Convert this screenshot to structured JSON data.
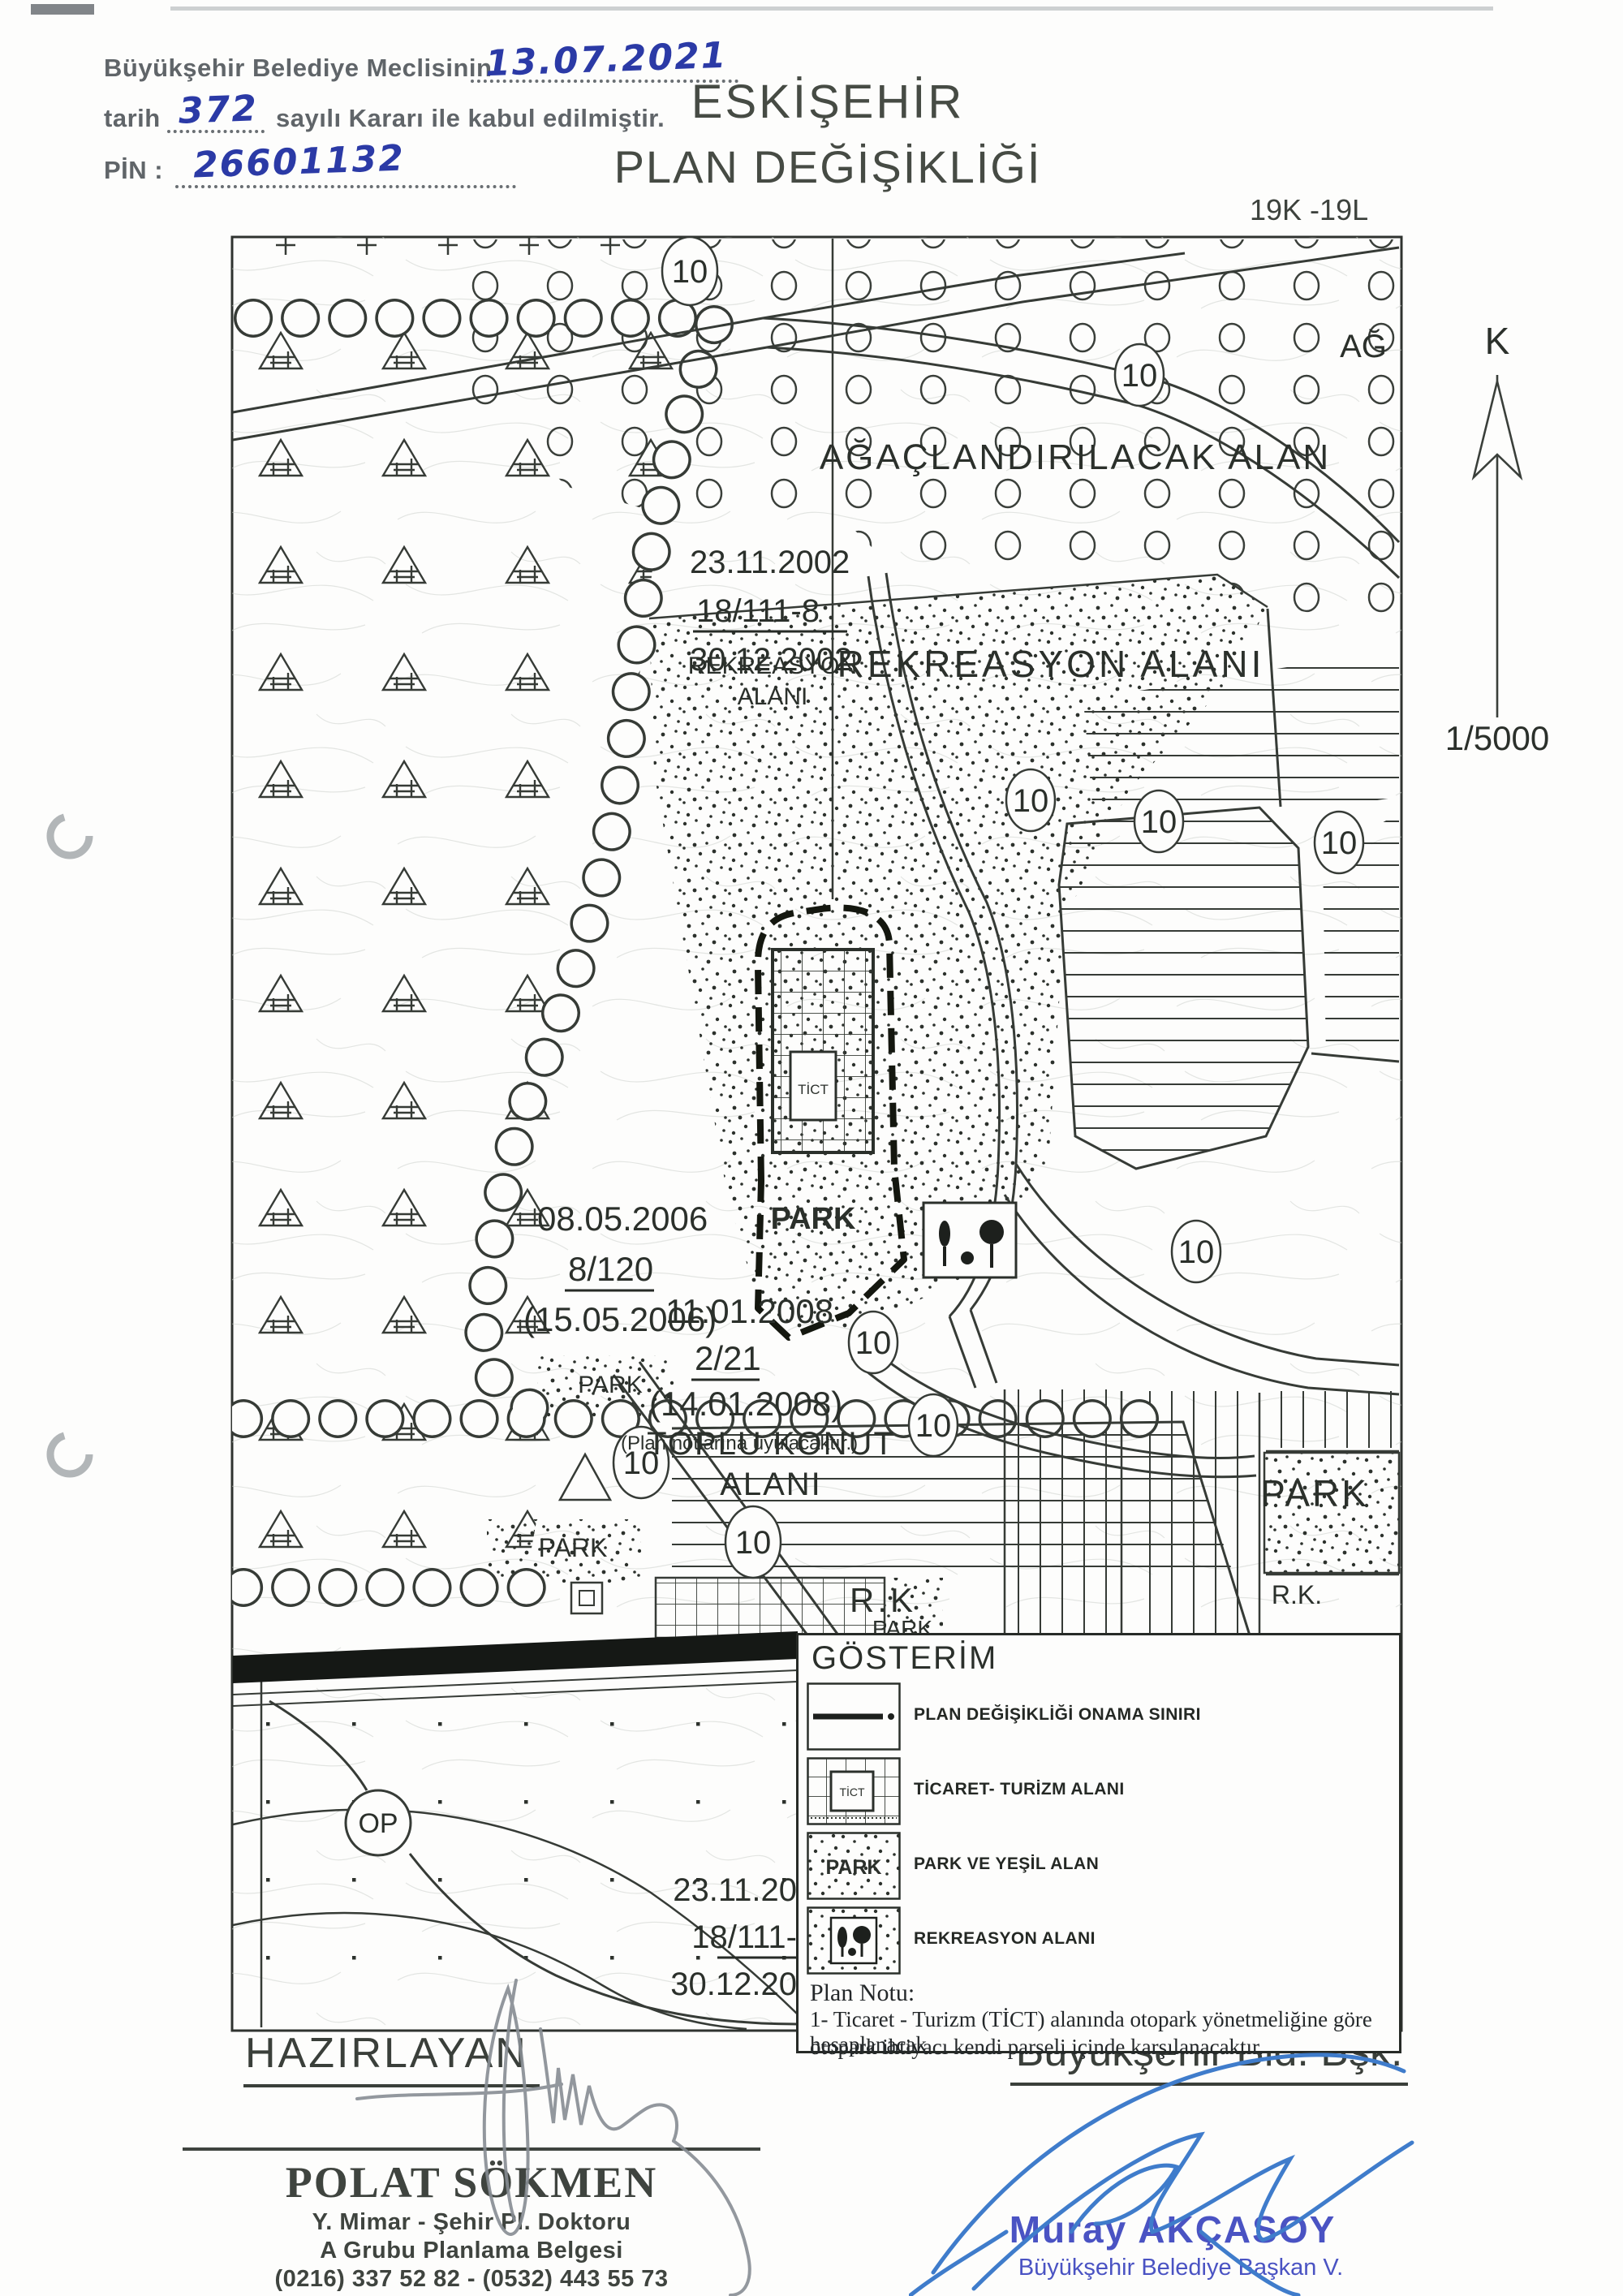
{
  "page": {
    "approval": {
      "line1_prefix": "Büyükşehir Belediye Meclisinin",
      "line1_value": "13.07.2021",
      "line2_prefix": "tarih",
      "line2_value": "372",
      "line2_suffix": "sayılı Kararı ile kabul edilmiştir.",
      "line3_prefix": "PİN :",
      "line3_value": "26601132"
    },
    "title_line1": "ESKİŞEHİR",
    "title_line2": "PLAN DEĞİŞİKLİĞİ",
    "sheet_code": "19K -19L",
    "north_label": "K",
    "scale_label": "1/5000"
  },
  "map": {
    "labels": {
      "afforestation": "AĞAÇLANDIRILACAK ALAN",
      "afforestation_short": "AĞ",
      "recreation_big": "REKREASYON ALANI",
      "recreation_small_1": "REKREASYON",
      "recreation_small_2": "ALANI",
      "mass_housing_1": "TOPLU KONUT",
      "mass_housing_2": "ALANI",
      "park": "PARK",
      "rk": "R.K",
      "rk_dotted": "R.K.",
      "op": "OP",
      "tict": "TİCT",
      "road_width": "10"
    },
    "revisions": {
      "r1a": "23.11.2002",
      "r1b": "18/111-8",
      "r1c": "30.12.2002",
      "r2a": "08.05.2006",
      "r2b": "8/120",
      "r2c": "(15.05.2006)",
      "r3a": "11.01.2008",
      "r3b": "2/21",
      "r3c": "(14.01.2008)",
      "r3d": "(Plan notlarına uyulacaktır.)",
      "r4a": "23.11.20",
      "r4b": "18/111-",
      "r4c": "30.12.20"
    }
  },
  "legend": {
    "title": "GÖSTERİM",
    "items": [
      {
        "label": "PLAN DEĞİŞİKLİĞİ ONAMA SINIRI"
      },
      {
        "label": "TİCARET- TURİZM ALANI",
        "swatch_text": "TİCT"
      },
      {
        "label": "PARK VE YEŞİL ALAN",
        "swatch_text": "PARK"
      },
      {
        "label": "REKREASYON ALANI"
      }
    ],
    "note_title": "Plan Notu:",
    "note_line1": "1- Ticaret - Turizm (TİCT) alanında otopark yönetmeliğine göre hesaplanacak",
    "note_line2": "otopark ihtiyacı kendi parseli içinde karşılanacaktır."
  },
  "footer": {
    "prepared_by": "HAZIRLAYAN",
    "stamp_name": "POLAT SÖKMEN",
    "stamp_title": "Y. Mimar - Şehir Pl. Doktoru",
    "stamp_cert": "A Grubu Planlama Belgesi",
    "stamp_phone": "(0216) 337 52 82 - (0532) 443 55 73",
    "approver_title": "Büyükşehir Bld. Bşk.",
    "approver_name": "Muray AKÇASOY",
    "approver_role": "Büyükşehir Belediye Başkan V."
  },
  "colors": {
    "ink_blue": "#2b3aa6",
    "stamp_blue": "#4a53c3",
    "signature_blue": "#3f7ccb",
    "map_ink": "#30352f"
  }
}
